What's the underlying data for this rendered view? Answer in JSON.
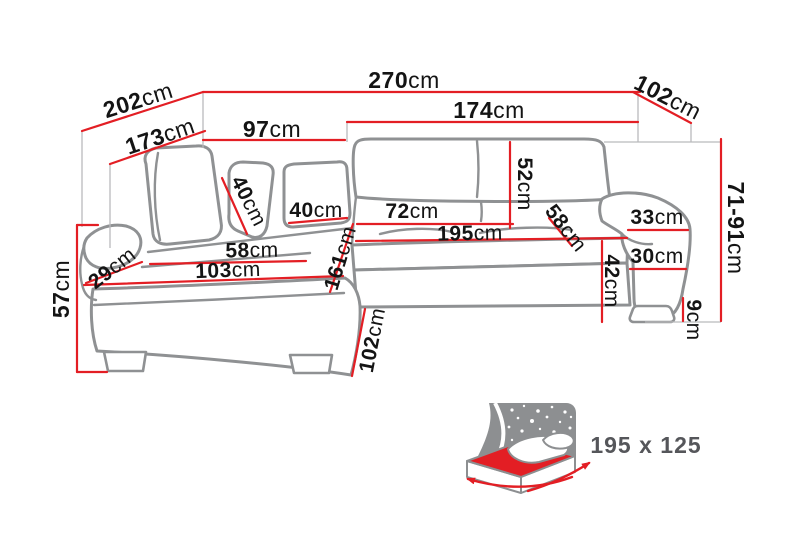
{
  "diagram": {
    "type": "corner-sofa-dimension-diagram",
    "unit": "cm",
    "colors": {
      "dimension_line": "#e31e24",
      "sofa_outline": "#8f9193",
      "label_text": "#141414",
      "icon_gray": "#8d8f91",
      "size_label_gray": "#55565a",
      "background": "#ffffff"
    },
    "dims": {
      "overall_width": {
        "value": "270",
        "unit": "cm"
      },
      "outer_diagonal_depth": {
        "value": "202",
        "unit": "cm"
      },
      "chaise_outer_length": {
        "value": "173",
        "unit": "cm"
      },
      "chaise_back_width": {
        "value": "97",
        "unit": "cm"
      },
      "sofa_back_width": {
        "value": "174",
        "unit": "cm"
      },
      "side_depth": {
        "value": "102",
        "unit": "cm"
      },
      "adjustable_height": {
        "value": "71-91",
        "unit": "cm"
      },
      "backrest_height": {
        "value": "52",
        "unit": "cm"
      },
      "headrest_cushion_height": {
        "value": "40",
        "unit": "cm"
      },
      "back_cushion_width": {
        "value": "40",
        "unit": "cm"
      },
      "seat_width": {
        "value": "72",
        "unit": "cm"
      },
      "bed_length": {
        "value": "195",
        "unit": "cm"
      },
      "seat_depth_diagonal": {
        "value": "58",
        "unit": "cm"
      },
      "chaise_seat_width": {
        "value": "58",
        "unit": "cm"
      },
      "chaise_seat_length": {
        "value": "103",
        "unit": "cm"
      },
      "armrest_width": {
        "value": "29",
        "unit": "cm"
      },
      "seat_height": {
        "value": "57",
        "unit": "cm"
      },
      "chaise_total_depth": {
        "value": "161",
        "unit": "cm"
      },
      "chaise_front_width": {
        "value": "102",
        "unit": "cm"
      },
      "armrest_top_depth": {
        "value": "33",
        "unit": "cm"
      },
      "armrest_front_width": {
        "value": "30",
        "unit": "cm"
      },
      "front_height": {
        "value": "42",
        "unit": "cm"
      },
      "leg_height": {
        "value": "9",
        "unit": "cm"
      }
    },
    "sleeping_function": {
      "icon": "fold-out-bed-icon",
      "size_label": "195 x 125"
    }
  }
}
